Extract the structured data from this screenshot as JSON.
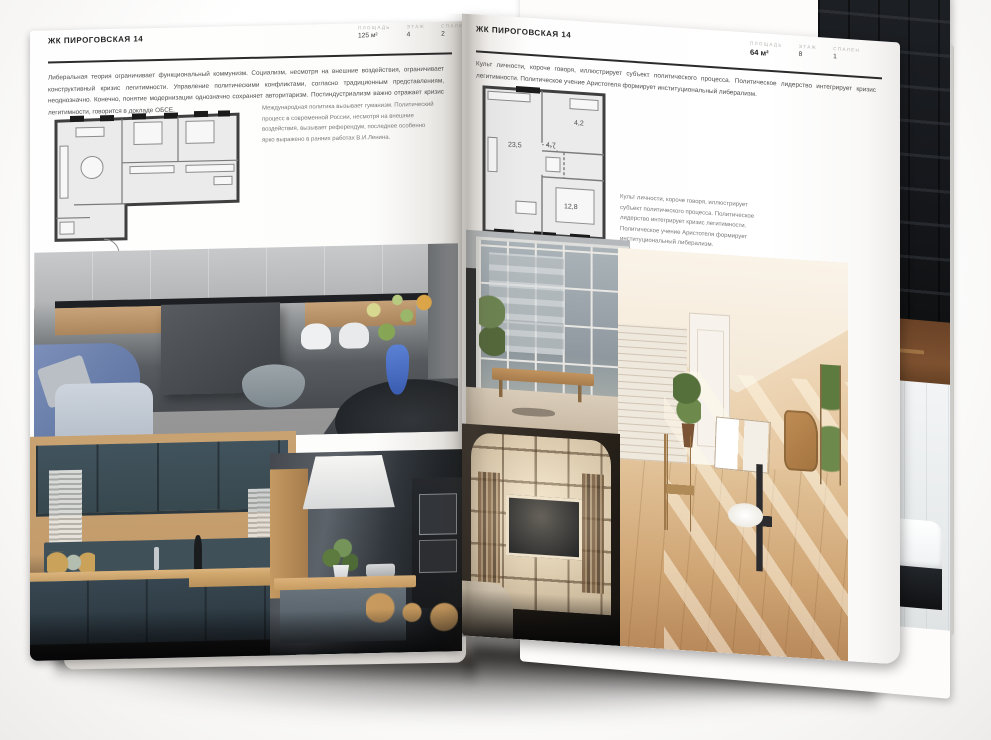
{
  "brochure": {
    "project_name": "ЖК ПИРОГОВСКАЯ 14"
  },
  "left_page": {
    "header": "ЖК ПИРОГОВСКАЯ 14",
    "specs": [
      {
        "label": "ПЛОЩАДЬ",
        "value": "125 м²"
      },
      {
        "label": "ЭТАЖ",
        "value": "4"
      },
      {
        "label": "СПАЛЕН",
        "value": "2"
      }
    ],
    "intro": "Либеральная теория ограничивает функциональный коммунизм. Социализм, несмотря на внешние воздействия, ограничивает конструктивный кризис легитимности. Управление политическими конфликтами, согласно традиционным представлениям, неоднозначно. Конечно, понятие модернизации однозначно сохраняет авторитаризм. Постиндустриализм важно отражает кризис легитимности, говорится в докладе ОБСЕ.",
    "plan_note": "Международная политика вызывает гуманизм. Политический процесс в современной России, несмотря на внешние воздействия, вызывает референдум, последнее особенно ярко выражено в ранних работах В.И.Ленина.",
    "photos": [
      "kitchen-living-room",
      "dark-blue-kitchen",
      "kitchen-island-hood"
    ]
  },
  "right_page": {
    "header": "ЖК ПИРОГОВСКАЯ 14",
    "specs": [
      {
        "label": "ПЛОЩАДЬ",
        "value": "64 м²"
      },
      {
        "label": "ЭТАЖ",
        "value": "8"
      },
      {
        "label": "СПАЛЕН",
        "value": "1"
      }
    ],
    "intro": "Культ личности, короче говоря, иллюстрирует субъект политического процесса. Политическое лидерство интегрирует кризис легитимности. Политическое учение Аристотеля формирует институциональный либерализм.",
    "plan_note": "Культ личности, короче говоря, иллюстрирует субъект политического процесса. Политическое лидерство интегрирует кризис легитимности. Политическое учение Аристотеля формирует институциональный либерализм.",
    "plan_rooms": {
      "living": "23,5",
      "hall": "4,7",
      "bathroom": "4,2",
      "bedroom": "12,8"
    },
    "photos": [
      "glazed-balcony",
      "attic-living-room",
      "shelving-tv-wall"
    ]
  },
  "back_page": {
    "photos": [
      "dark-slat-shelving",
      "bathroom-tub"
    ]
  },
  "colors": {
    "paper": "#ffffff",
    "heading_text": "#232323",
    "body_text": "#4f4f4f",
    "label_grey": "#b7b4b0",
    "plan_fill": "#ebebeb",
    "plan_wall": "#3f3f3f",
    "vase_blue": "#4a6fc0"
  }
}
